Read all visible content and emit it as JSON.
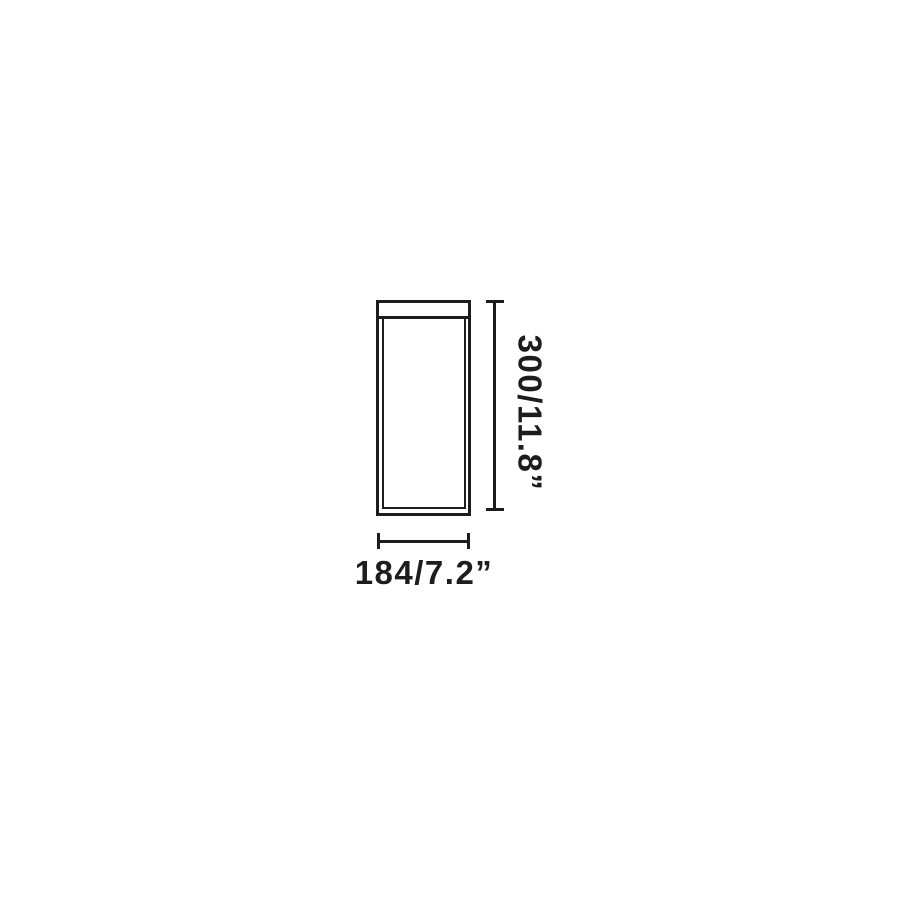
{
  "page": {
    "background_color": "#ffffff"
  },
  "diagram": {
    "kind": "product-dimension-drawing",
    "line_color": "#1d1d1b",
    "object": {
      "shape": "vertical-rectangle-with-top-cap-and-inner-panel"
    },
    "dimensions": {
      "height": {
        "label": "300/11.8”",
        "millimeters": 300,
        "inches": 11.8,
        "orientation": "vertical"
      },
      "width": {
        "label": "184/7.2”",
        "millimeters": 184,
        "inches": 7.2,
        "orientation": "horizontal"
      }
    }
  }
}
